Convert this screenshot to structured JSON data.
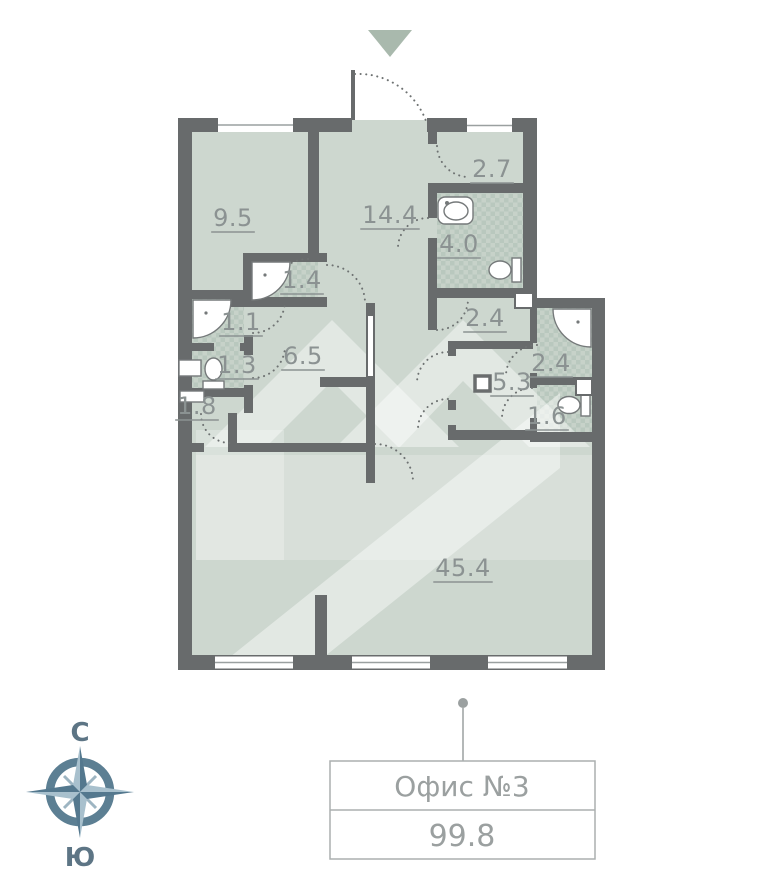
{
  "plan": {
    "unit": {
      "name": "Офис №3",
      "area": "99.8"
    },
    "compass": {
      "north": "С",
      "south": "Ю"
    },
    "rooms": [
      {
        "id": "9-5",
        "area": "9.5",
        "x": 233,
        "y": 226
      },
      {
        "id": "14-4",
        "area": "14.4",
        "x": 390,
        "y": 223
      },
      {
        "id": "2-7",
        "area": "2.7",
        "x": 492,
        "y": 177
      },
      {
        "id": "4-0",
        "area": "4.0",
        "x": 459,
        "y": 252
      },
      {
        "id": "1-4",
        "area": "1.4",
        "x": 302,
        "y": 288
      },
      {
        "id": "1-1",
        "area": "1.1",
        "x": 241,
        "y": 330
      },
      {
        "id": "1-3",
        "area": "1.3",
        "x": 237,
        "y": 373
      },
      {
        "id": "6-5",
        "area": "6.5",
        "x": 303,
        "y": 364
      },
      {
        "id": "1-8",
        "area": "1.8",
        "x": 197,
        "y": 414
      },
      {
        "id": "2-4-hall",
        "area": "2.4",
        "x": 485,
        "y": 326
      },
      {
        "id": "2-4-shower",
        "area": "2.4",
        "x": 551,
        "y": 371
      },
      {
        "id": "5-3",
        "area": "5.3",
        "x": 512,
        "y": 390
      },
      {
        "id": "1-6",
        "area": "1.6",
        "x": 547,
        "y": 424
      },
      {
        "id": "45-4",
        "area": "45.4",
        "x": 463,
        "y": 576
      }
    ],
    "colors": {
      "wall": "#686b6c",
      "floor": "#cdd7cf",
      "wet_floor": "#c7d2c9",
      "wet_check": "#b9c8be",
      "label": "#8b9292",
      "door_arc": "#6e7272",
      "entrance_arrow": "#a9b9ad",
      "compass_ring": "#5c7f93",
      "compass_star_light": "#a8c0cd",
      "compass_star_dark": "#54788e",
      "box_border": "#abafaf",
      "box_text": "#9ba0a0"
    }
  }
}
